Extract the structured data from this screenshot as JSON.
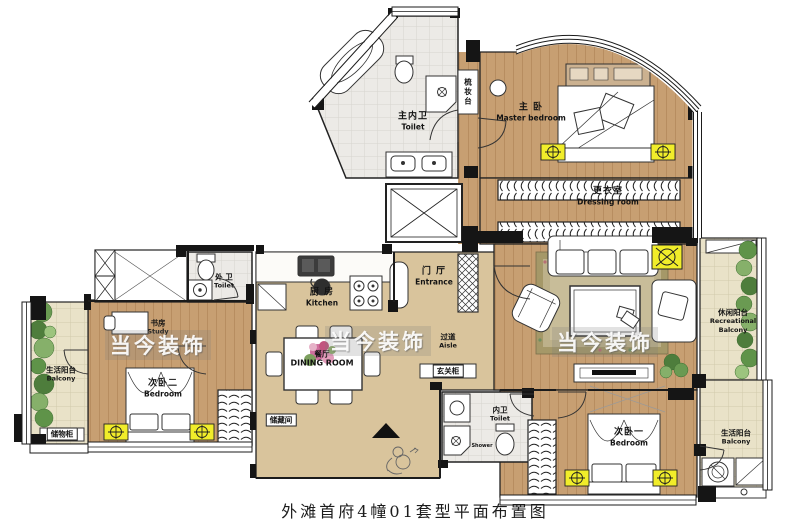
{
  "caption": "外滩首府4幢01套型平面布置图",
  "watermark": "当今装饰",
  "colors": {
    "wood_floor": "#c79f72",
    "tile_floor": "#d9c49c",
    "bath_floor": "#eceae6",
    "balcony_floor": "#e9e2c8",
    "wall": "#151515",
    "fixture_yellow": "#f1ed2a",
    "plant_green": "#5f9349",
    "rug_olive": "#a59868",
    "watermark_white": "#ffffff"
  },
  "rooms": {
    "master_bedroom": {
      "cn": "主 卧",
      "en": "Master bedroom"
    },
    "dressing_room": {
      "cn": "更衣室",
      "en": "Dressing room"
    },
    "master_toilet": {
      "cn": "主内卫",
      "en": "Toilet"
    },
    "vanity": {
      "cn": "梳妆台"
    },
    "outer_toilet": {
      "cn": "外 卫",
      "en": "Toilet"
    },
    "kitchen": {
      "cn": "厨 房",
      "en": "Kitchen"
    },
    "entrance": {
      "cn": "门 厅",
      "en": "Entrance"
    },
    "aisle": {
      "cn": "过道",
      "en": "Aisle"
    },
    "entry_cabinet": {
      "cn": "玄关柜"
    },
    "study": {
      "cn": "书房",
      "en": "Study"
    },
    "bedroom_two": {
      "cn": "次卧二",
      "en": "Bedroom"
    },
    "dining": {
      "cn": "餐厅",
      "en": "DINING ROOM"
    },
    "storage_room": {
      "cn": "储藏间"
    },
    "storage_cabinet": {
      "cn": "储物柜"
    },
    "inner_toilet": {
      "cn": "内卫",
      "en": "Toilet"
    },
    "shower": {
      "en": "Shower"
    },
    "bedroom_one": {
      "cn": "次卧一",
      "en": "Bedroom"
    },
    "life_balcony_left": {
      "cn": "生活阳台",
      "en": "Balcony"
    },
    "recreational_balcony": {
      "cn": "休闲阳台",
      "en": "Recreational Balcony"
    },
    "life_balcony_right": {
      "cn": "生活阳台",
      "en": "Balcony"
    }
  }
}
